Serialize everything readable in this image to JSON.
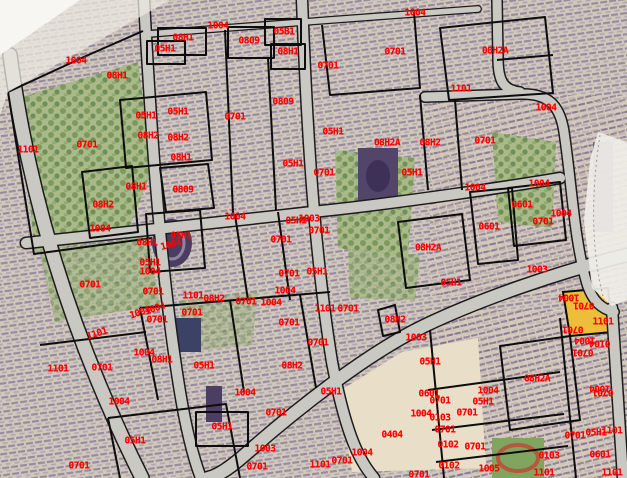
{
  "map": {
    "description": "Aerial cadastral map with black parcel boundaries and red parcel-code labels",
    "colors": {
      "label": "#ff0000",
      "boundary": "#0d0d0d",
      "road": "#c9c8c2",
      "highlight_parcel": "#edbe3a",
      "open_area": "#e9dfc9",
      "ground": "#d7d0c3"
    },
    "labels": [
      {
        "text": "1004",
        "x": 76,
        "y": 61
      },
      {
        "text": "08H1",
        "x": 117,
        "y": 76
      },
      {
        "text": "1101",
        "x": 28,
        "y": 150
      },
      {
        "text": "0701",
        "x": 87,
        "y": 145
      },
      {
        "text": "08H1",
        "x": 183,
        "y": 38
      },
      {
        "text": "05H1",
        "x": 165,
        "y": 49
      },
      {
        "text": "1004",
        "x": 218,
        "y": 26
      },
      {
        "text": "0809",
        "x": 249,
        "y": 41
      },
      {
        "text": "05B1",
        "x": 284,
        "y": 32
      },
      {
        "text": "08H1",
        "x": 288,
        "y": 52
      },
      {
        "text": "0701",
        "x": 328,
        "y": 66
      },
      {
        "text": "0701",
        "x": 395,
        "y": 52
      },
      {
        "text": "1004",
        "x": 415,
        "y": 13
      },
      {
        "text": "08H2A",
        "x": 495,
        "y": 51
      },
      {
        "text": "1101",
        "x": 461,
        "y": 89
      },
      {
        "text": "1004",
        "x": 546,
        "y": 108
      },
      {
        "text": "0809",
        "x": 283,
        "y": 102
      },
      {
        "text": "05H1",
        "x": 146,
        "y": 116
      },
      {
        "text": "05H1",
        "x": 178,
        "y": 112
      },
      {
        "text": "0701",
        "x": 235,
        "y": 117
      },
      {
        "text": "08H2",
        "x": 148,
        "y": 136
      },
      {
        "text": "08H2",
        "x": 178,
        "y": 138
      },
      {
        "text": "05H1",
        "x": 333,
        "y": 132
      },
      {
        "text": "0701",
        "x": 485,
        "y": 141
      },
      {
        "text": "08H2A",
        "x": 387,
        "y": 143
      },
      {
        "text": "08H2",
        "x": 430,
        "y": 143
      },
      {
        "text": "08H1",
        "x": 181,
        "y": 158
      },
      {
        "text": "05H1",
        "x": 293,
        "y": 164
      },
      {
        "text": "0701",
        "x": 324,
        "y": 173
      },
      {
        "text": "05H1",
        "x": 412,
        "y": 173
      },
      {
        "text": "08H1",
        "x": 136,
        "y": 187
      },
      {
        "text": "0809",
        "x": 183,
        "y": 190
      },
      {
        "text": "1004",
        "x": 475,
        "y": 188
      },
      {
        "text": "1004",
        "x": 539,
        "y": 184
      },
      {
        "text": "08H2",
        "x": 103,
        "y": 205
      },
      {
        "text": "0601",
        "x": 522,
        "y": 205
      },
      {
        "text": "1004",
        "x": 561,
        "y": 214
      },
      {
        "text": "1004",
        "x": 235,
        "y": 217
      },
      {
        "text": "1003",
        "x": 309,
        "y": 219
      },
      {
        "text": "05H1",
        "x": 296,
        "y": 221
      },
      {
        "text": "0701",
        "x": 543,
        "y": 222
      },
      {
        "text": "1004",
        "x": 100,
        "y": 229
      },
      {
        "text": "0601",
        "x": 489,
        "y": 227
      },
      {
        "text": "0701",
        "x": 319,
        "y": 231
      },
      {
        "text": "05H1",
        "x": 181,
        "y": 236
      },
      {
        "text": "0701",
        "x": 281,
        "y": 240
      },
      {
        "text": "08H1",
        "x": 147,
        "y": 243
      },
      {
        "text": "1004",
        "x": 171,
        "y": 245,
        "rot": -15
      },
      {
        "text": "08H2A",
        "x": 428,
        "y": 248
      },
      {
        "text": "05H1",
        "x": 150,
        "y": 263
      },
      {
        "text": "1004",
        "x": 150,
        "y": 272
      },
      {
        "text": "1003",
        "x": 537,
        "y": 270
      },
      {
        "text": "0701",
        "x": 289,
        "y": 274
      },
      {
        "text": "05H1",
        "x": 317,
        "y": 272
      },
      {
        "text": "05H1",
        "x": 451,
        "y": 283
      },
      {
        "text": "0701",
        "x": 90,
        "y": 285
      },
      {
        "text": "1004",
        "x": 285,
        "y": 291
      },
      {
        "text": "0701",
        "x": 153,
        "y": 292
      },
      {
        "text": "1101",
        "x": 193,
        "y": 296
      },
      {
        "text": "1004",
        "x": 569,
        "y": 297,
        "rot": 180
      },
      {
        "text": "08H2",
        "x": 214,
        "y": 299
      },
      {
        "text": "0701",
        "x": 246,
        "y": 302
      },
      {
        "text": "1004",
        "x": 271,
        "y": 303
      },
      {
        "text": "0701",
        "x": 584,
        "y": 305,
        "rot": 180
      },
      {
        "text": "1101",
        "x": 325,
        "y": 309
      },
      {
        "text": "0701",
        "x": 348,
        "y": 309
      },
      {
        "text": "1004",
        "x": 155,
        "y": 309,
        "rot": -18
      },
      {
        "text": "1004",
        "x": 140,
        "y": 313,
        "rot": -18
      },
      {
        "text": "0701",
        "x": 192,
        "y": 313
      },
      {
        "text": "0701",
        "x": 157,
        "y": 320
      },
      {
        "text": "08H2",
        "x": 395,
        "y": 320
      },
      {
        "text": "1101",
        "x": 603,
        "y": 322
      },
      {
        "text": "0701",
        "x": 289,
        "y": 323
      },
      {
        "text": "0701",
        "x": 573,
        "y": 329,
        "rot": 180
      },
      {
        "text": "1101",
        "x": 97,
        "y": 334,
        "rot": -18
      },
      {
        "text": "1003",
        "x": 416,
        "y": 338
      },
      {
        "text": "1004",
        "x": 585,
        "y": 340,
        "rot": 180
      },
      {
        "text": "0104",
        "x": 600,
        "y": 343,
        "rot": 180
      },
      {
        "text": "0701",
        "x": 318,
        "y": 343
      },
      {
        "text": "0701",
        "x": 583,
        "y": 352,
        "rot": 180
      },
      {
        "text": "1004",
        "x": 144,
        "y": 353
      },
      {
        "text": "08H1",
        "x": 162,
        "y": 360
      },
      {
        "text": "05H1",
        "x": 204,
        "y": 366
      },
      {
        "text": "05H1",
        "x": 430,
        "y": 362
      },
      {
        "text": "08H2",
        "x": 292,
        "y": 366
      },
      {
        "text": "1101",
        "x": 58,
        "y": 369
      },
      {
        "text": "0701",
        "x": 102,
        "y": 368
      },
      {
        "text": "08H2A",
        "x": 537,
        "y": 379
      },
      {
        "text": "1004",
        "x": 600,
        "y": 388,
        "rot": 180
      },
      {
        "text": "0701",
        "x": 603,
        "y": 392,
        "rot": 180
      },
      {
        "text": "05H1",
        "x": 331,
        "y": 392
      },
      {
        "text": "0601",
        "x": 429,
        "y": 394
      },
      {
        "text": "1004",
        "x": 488,
        "y": 391
      },
      {
        "text": "1004",
        "x": 245,
        "y": 393
      },
      {
        "text": "05H1",
        "x": 483,
        "y": 402
      },
      {
        "text": "0701",
        "x": 440,
        "y": 401
      },
      {
        "text": "1004",
        "x": 119,
        "y": 402
      },
      {
        "text": "0701",
        "x": 276,
        "y": 413
      },
      {
        "text": "0701",
        "x": 467,
        "y": 413
      },
      {
        "text": "1004",
        "x": 421,
        "y": 414
      },
      {
        "text": "0103",
        "x": 440,
        "y": 418
      },
      {
        "text": "05H1",
        "x": 222,
        "y": 427
      },
      {
        "text": "0701",
        "x": 445,
        "y": 430
      },
      {
        "text": "1101",
        "x": 612,
        "y": 431
      },
      {
        "text": "05H1",
        "x": 596,
        "y": 433
      },
      {
        "text": "0404",
        "x": 392,
        "y": 435
      },
      {
        "text": "0701",
        "x": 575,
        "y": 436
      },
      {
        "text": "05H1",
        "x": 135,
        "y": 441
      },
      {
        "text": "0102",
        "x": 448,
        "y": 445
      },
      {
        "text": "0701",
        "x": 475,
        "y": 447
      },
      {
        "text": "1003",
        "x": 265,
        "y": 449
      },
      {
        "text": "1004",
        "x": 362,
        "y": 453
      },
      {
        "text": "0103",
        "x": 549,
        "y": 456
      },
      {
        "text": "0601",
        "x": 600,
        "y": 455
      },
      {
        "text": "0701",
        "x": 342,
        "y": 461
      },
      {
        "text": "1101",
        "x": 320,
        "y": 465
      },
      {
        "text": "0102",
        "x": 449,
        "y": 466
      },
      {
        "text": "0701",
        "x": 257,
        "y": 467
      },
      {
        "text": "0701",
        "x": 79,
        "y": 466
      },
      {
        "text": "1005",
        "x": 489,
        "y": 469
      },
      {
        "text": "1101",
        "x": 544,
        "y": 473
      },
      {
        "text": "1101",
        "x": 612,
        "y": 473
      },
      {
        "text": "0701",
        "x": 419,
        "y": 475
      }
    ]
  }
}
